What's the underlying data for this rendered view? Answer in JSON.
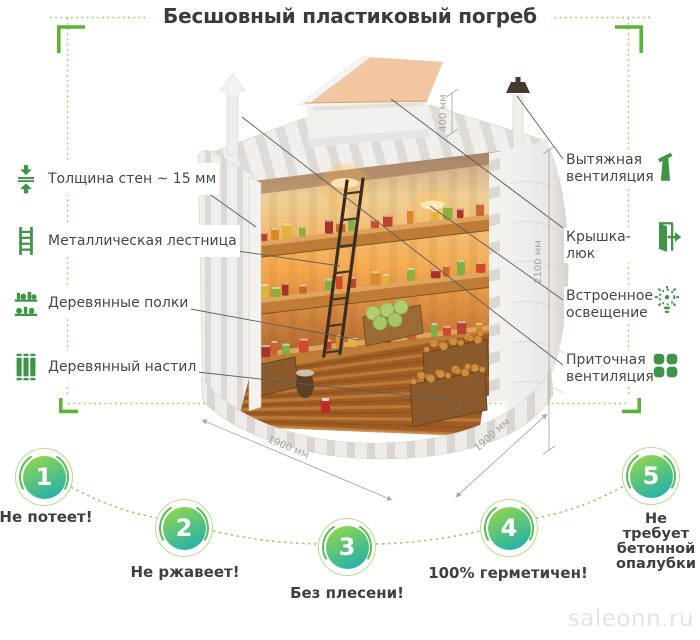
{
  "title": "Бесшовный пластиковый погреб",
  "left_labels": [
    {
      "icon": "wall-thickness-icon",
      "label": "Толщина стен ~ 15 мм"
    },
    {
      "icon": "ladder-icon",
      "label": "Металлическая лестница"
    },
    {
      "icon": "shelves-icon",
      "label": "Деревянные полки"
    },
    {
      "icon": "decking-icon",
      "label": "Деревянный настил"
    }
  ],
  "right_labels": [
    {
      "icon": "exhaust-vent-icon",
      "label": "Вытяжная вентиляция"
    },
    {
      "icon": "hatch-lid-icon",
      "label": "Крышка-люк"
    },
    {
      "icon": "light-bulb-icon",
      "label": "Встроенное освещение"
    },
    {
      "icon": "supply-vent-icon",
      "label": "Приточная вентиляция"
    }
  ],
  "dimensions": {
    "neck_height": "400 мм",
    "body_height": "2100 мм",
    "depth": "1900 мм",
    "width": "1900 мм"
  },
  "benefits": [
    {
      "number": "1",
      "label": "Не потеет!"
    },
    {
      "number": "2",
      "label": "Не ржавеет!"
    },
    {
      "number": "3",
      "label": "Без плесени!"
    },
    {
      "number": "4",
      "label": "100% герметичен!"
    },
    {
      "number": "5",
      "label": "Не требует бетонной опалубки"
    }
  ],
  "watermark": "saleonn.ru",
  "colors": {
    "accent_green": "#5cb435",
    "dotted_green": "#9cd370",
    "icon_green": "#3f9447",
    "badge_gradient_start": "#90d64e",
    "badge_gradient_end": "#27b2a8",
    "text": "#414141",
    "dimension_text": "#a3a3a3"
  }
}
